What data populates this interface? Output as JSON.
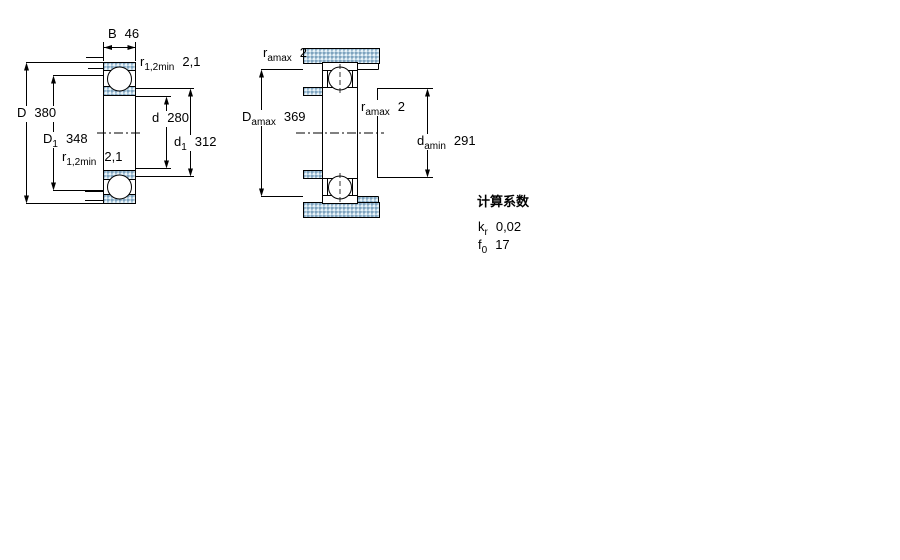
{
  "figure": {
    "left_diagram": {
      "dims": {
        "B": {
          "main": "B",
          "sub": "",
          "value": "46"
        },
        "r12_top": {
          "main": "r",
          "sub": "1,2min",
          "value": "2,1"
        },
        "D": {
          "main": "D",
          "sub": "",
          "value": "380"
        },
        "d": {
          "main": "d",
          "sub": "",
          "value": "280"
        },
        "D1": {
          "main": "D",
          "sub": "1",
          "value": "348"
        },
        "r12_bot": {
          "main": "r",
          "sub": "1,2min",
          "value": "2,1"
        },
        "d1": {
          "main": "d",
          "sub": "1",
          "value": "312"
        }
      }
    },
    "right_diagram": {
      "dims": {
        "ra_top": {
          "main": "r",
          "sub": "amax",
          "value": "2"
        },
        "Da": {
          "main": "D",
          "sub": "amax",
          "value": "369"
        },
        "ra_mid": {
          "main": "r",
          "sub": "amax",
          "value": "2"
        },
        "da": {
          "main": "d",
          "sub": "amin",
          "value": "291"
        }
      }
    },
    "factors": {
      "title": "计算系数",
      "rows": [
        {
          "main": "k",
          "sub": "r",
          "value": "0,02"
        },
        {
          "main": "f",
          "sub": "0",
          "value": "17"
        }
      ]
    },
    "colors": {
      "line": "#000000",
      "hatch_fill": "#b4cfdf",
      "hatch_dot": "#7fa3bf",
      "background": "#ffffff"
    }
  }
}
